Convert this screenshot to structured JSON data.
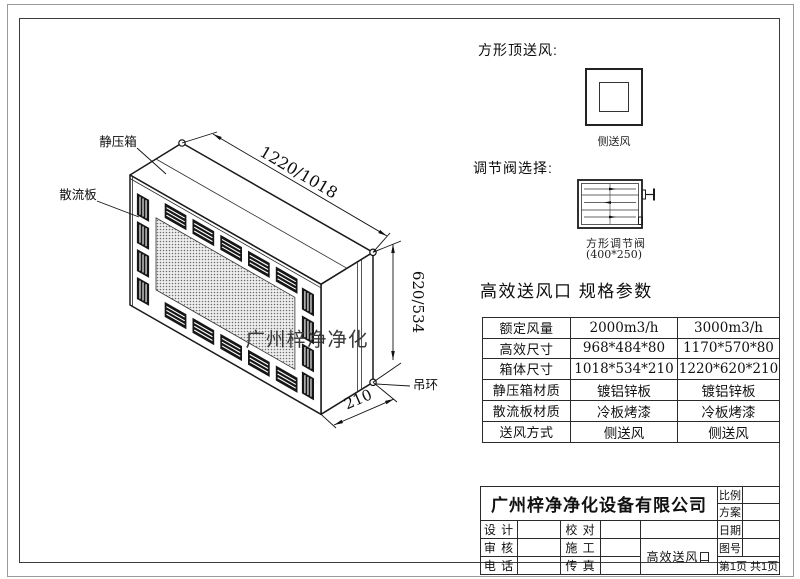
{
  "drawing": {
    "label_plenum": "静压箱",
    "label_diffuser": "散流板",
    "label_ring": "吊环",
    "watermark": "广州梓净净化",
    "dim_width": "1220/1018",
    "dim_height": "620/534",
    "dim_depth": "210"
  },
  "top_supply": {
    "heading": "方形顶送风:",
    "caption": "侧送风"
  },
  "valve": {
    "heading": "调节阀选择:",
    "name": "方形调节阀",
    "size": "(400*250)"
  },
  "spec": {
    "heading": "高效送风口  规格参数",
    "rows": [
      {
        "label": "额定风量",
        "v1": "2000m3/h",
        "v2": "3000m3/h"
      },
      {
        "label": "高效尺寸",
        "v1": "968*484*80",
        "v2": "1170*570*80"
      },
      {
        "label": "箱体尺寸",
        "v1": "1018*534*210",
        "v2": "1220*620*210"
      },
      {
        "label": "静压箱材质",
        "v1": "镀铝锌板",
        "v2": "镀铝锌板"
      },
      {
        "label": "散流板材质",
        "v1": "冷板烤漆",
        "v2": "冷板烤漆"
      },
      {
        "label": "送风方式",
        "v1": "侧送风",
        "v2": "侧送风"
      }
    ]
  },
  "titleblock": {
    "company": "广州梓净净化设备有限公司",
    "scale_label": "比例",
    "plan_label": "方案",
    "design_label": "设 计",
    "proof_label": "校 对",
    "date_label": "日期",
    "audit_label": "审 核",
    "construct_label": "施 工",
    "dwg_no_label": "图号",
    "phone_label": "电 话",
    "fax_label": "传 真",
    "product": "高效送风口",
    "page_info": "第1页 共1页"
  }
}
